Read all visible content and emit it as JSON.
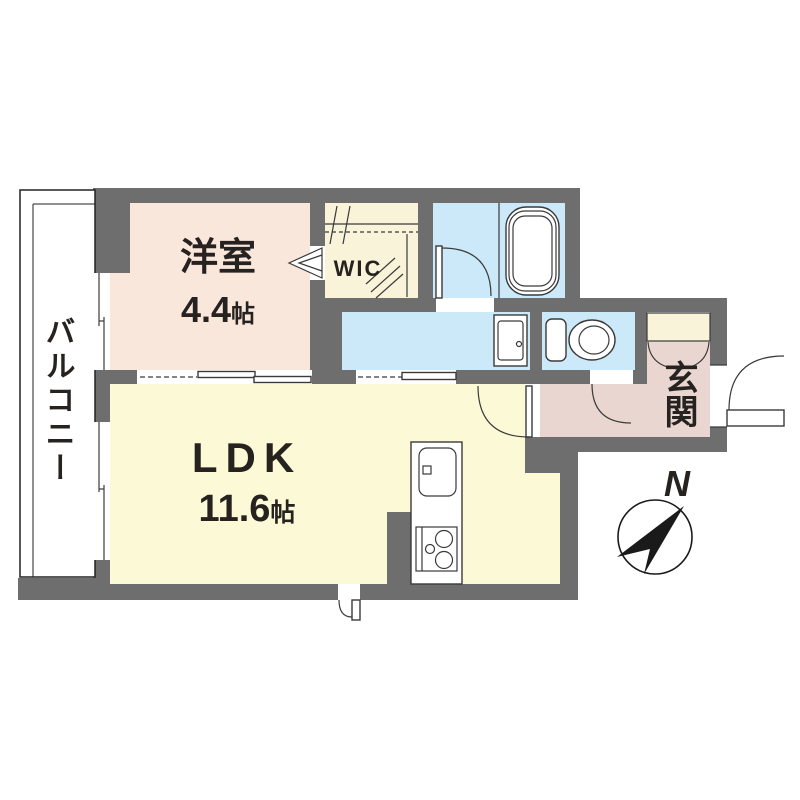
{
  "floorplan": {
    "balcony": {
      "label": "バルコニー"
    },
    "western_room": {
      "label": "洋室",
      "size": "4.4",
      "unit": "帖"
    },
    "wic": {
      "label": "WIC"
    },
    "ldk": {
      "label": "LDK",
      "size": "11.6",
      "unit": "帖"
    },
    "genkan": {
      "label": "玄関"
    },
    "compass": {
      "north_label": "N"
    },
    "colors": {
      "wall": "#6e6e6e",
      "western_room_fill": "#fae7dc",
      "ldk_fill": "#fcfad6",
      "wet_area_fill": "#cbe9f8",
      "closet_fill": "#f8f3d9",
      "hall_fill": "#e9d6d0",
      "line": "#3a3a3a"
    }
  }
}
